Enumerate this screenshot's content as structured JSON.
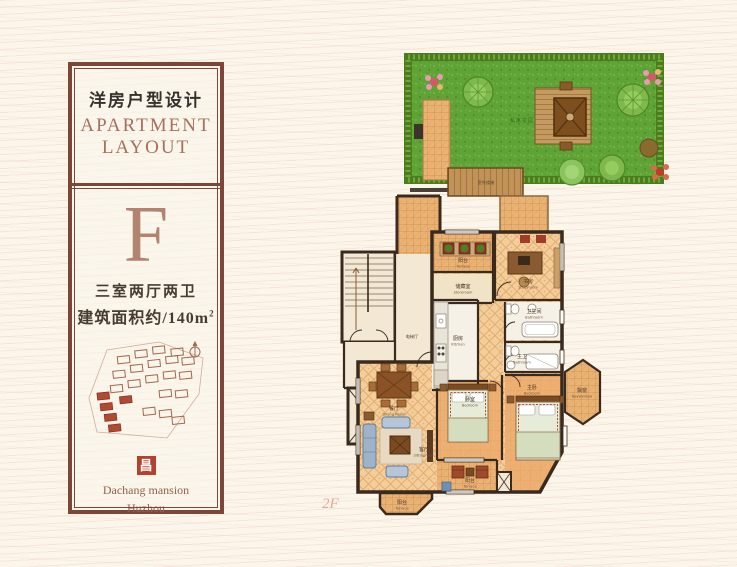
{
  "panel": {
    "title_zh": "洋房户型设计",
    "title_en_line1": "APARTMENT",
    "title_en_line2": "LAYOUT",
    "unit_letter": "F",
    "spec_rooms": "三室两厅两卫",
    "spec_area": "建筑面积约/140m",
    "spec_area_sup": "2",
    "logo_glyph": "昌",
    "brand_line1": "Dachang mansion",
    "brand_line2": "Huzhou"
  },
  "plan": {
    "floor_label": "2F",
    "garden_label": "私家花园",
    "deck_label": "室外楼梯",
    "rooms": {
      "terrace_top": {
        "zh": "阳台",
        "en": "Terrace"
      },
      "storeroom": {
        "zh": "储藏室",
        "en": "Storeroom"
      },
      "study": {
        "zh": "书房",
        "en": "Studyroom"
      },
      "bath1": {
        "zh": "卫生间",
        "en": "Bathroom"
      },
      "bath2": {
        "zh": "主卫",
        "en": "Bathroom"
      },
      "kitchen": {
        "zh": "厨房",
        "en": "Kitchen"
      },
      "dining": {
        "zh": "餐厅",
        "en": "Dining Room"
      },
      "living": {
        "zh": "客厅",
        "en": "Sittingroom"
      },
      "bedroom": {
        "zh": "卧室",
        "en": "Bedroom"
      },
      "master_bedroom": {
        "zh": "主卧",
        "en": "Bedroom"
      },
      "bay_window": {
        "zh": "飘窗",
        "en": "Baywindow"
      },
      "terrace_bottom": {
        "zh": "阳台",
        "en": "Terrace"
      },
      "balcony_bottom": {
        "zh": "阳台",
        "en": "Terrace"
      },
      "elevator_hall": {
        "zh": "电梯厅",
        "en": ""
      }
    }
  },
  "colors": {
    "panel_border": "#7c4736",
    "accent_red": "#b5402e",
    "title_brown": "#a5705c",
    "tile": "#eab374",
    "floor": "#f3cd9a",
    "lawn": "#5fa337",
    "wall": "#3a2a1e",
    "background": "#fbf5ea"
  }
}
